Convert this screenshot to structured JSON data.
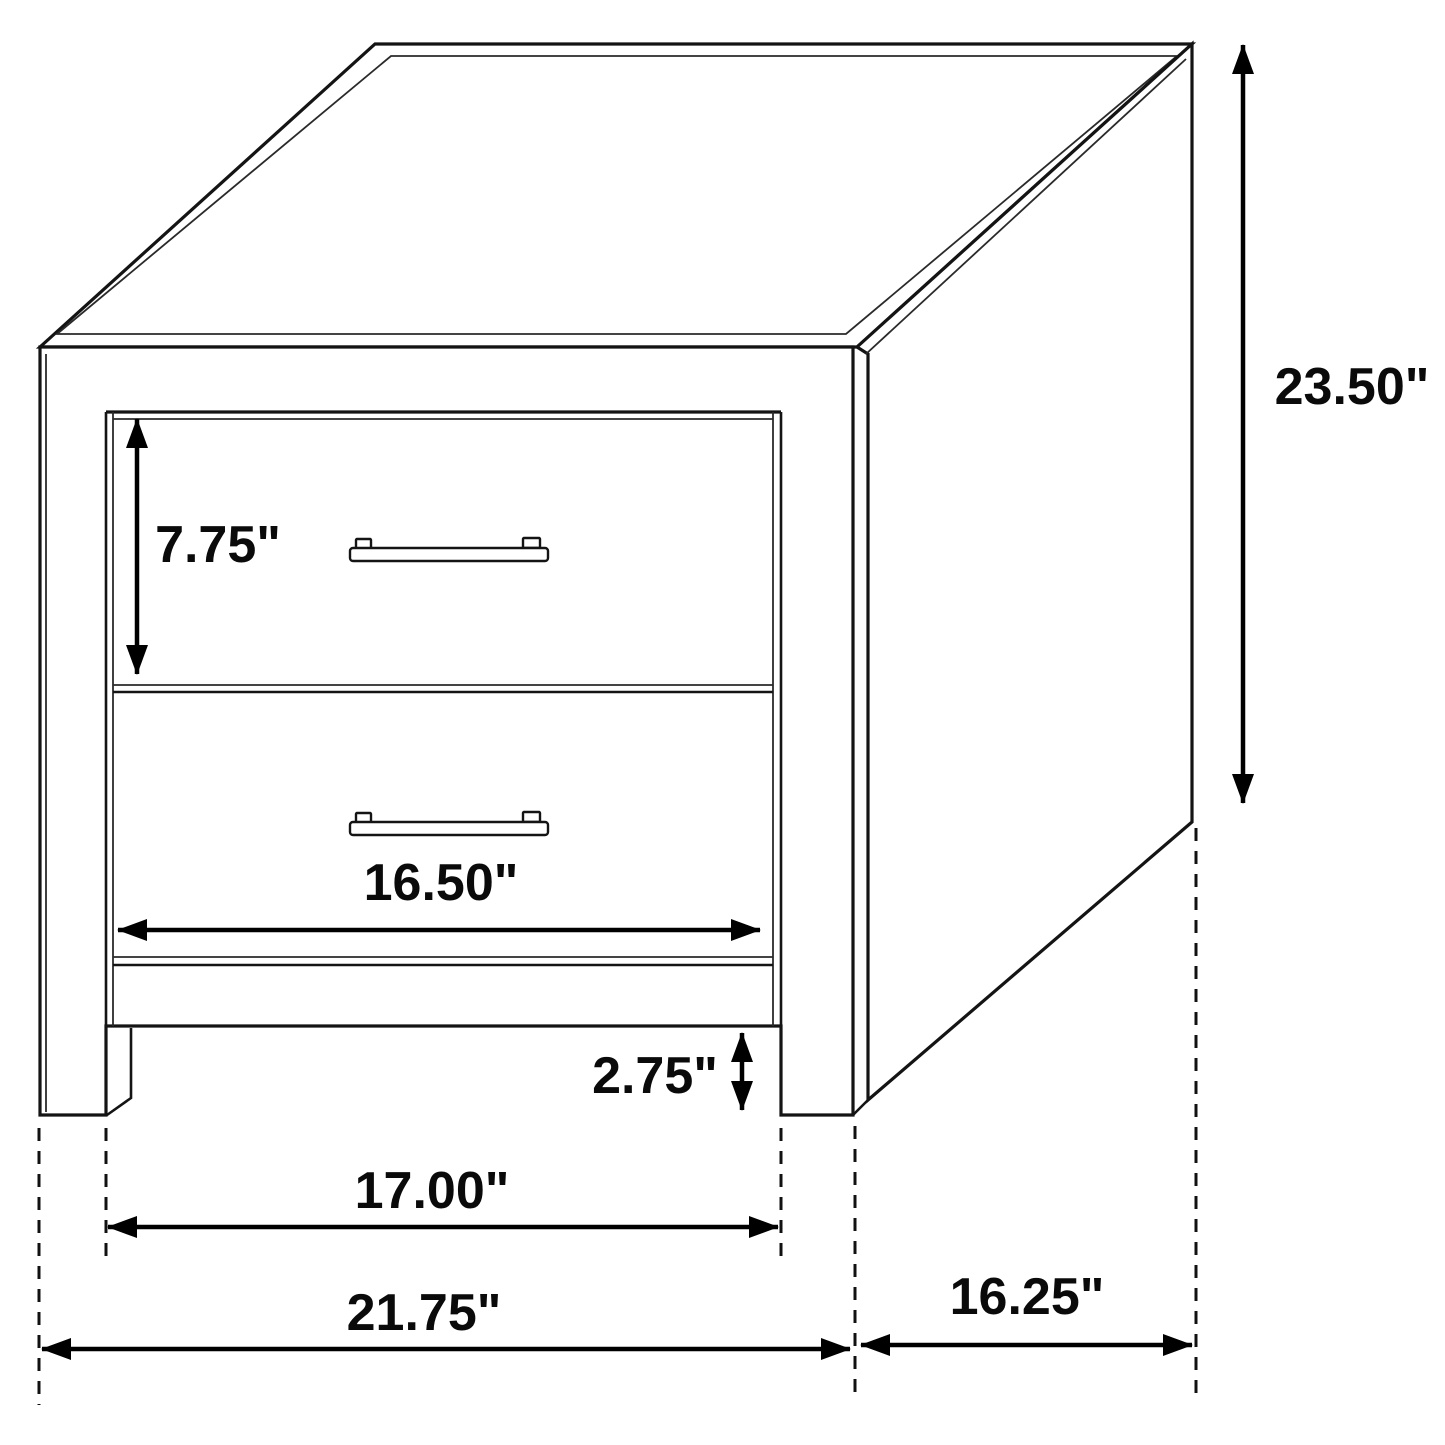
{
  "dimensions": {
    "overall_height": "23.50\"",
    "drawer_front_height": "7.75\"",
    "drawer_width": "16.50\"",
    "leg_clearance_height": "2.75\"",
    "leg_span_width": "17.00\"",
    "overall_width": "21.75\"",
    "side_depth": "16.25\""
  },
  "colors": {
    "line": "#141414",
    "dimension_line": "#000000",
    "background": "#ffffff"
  }
}
